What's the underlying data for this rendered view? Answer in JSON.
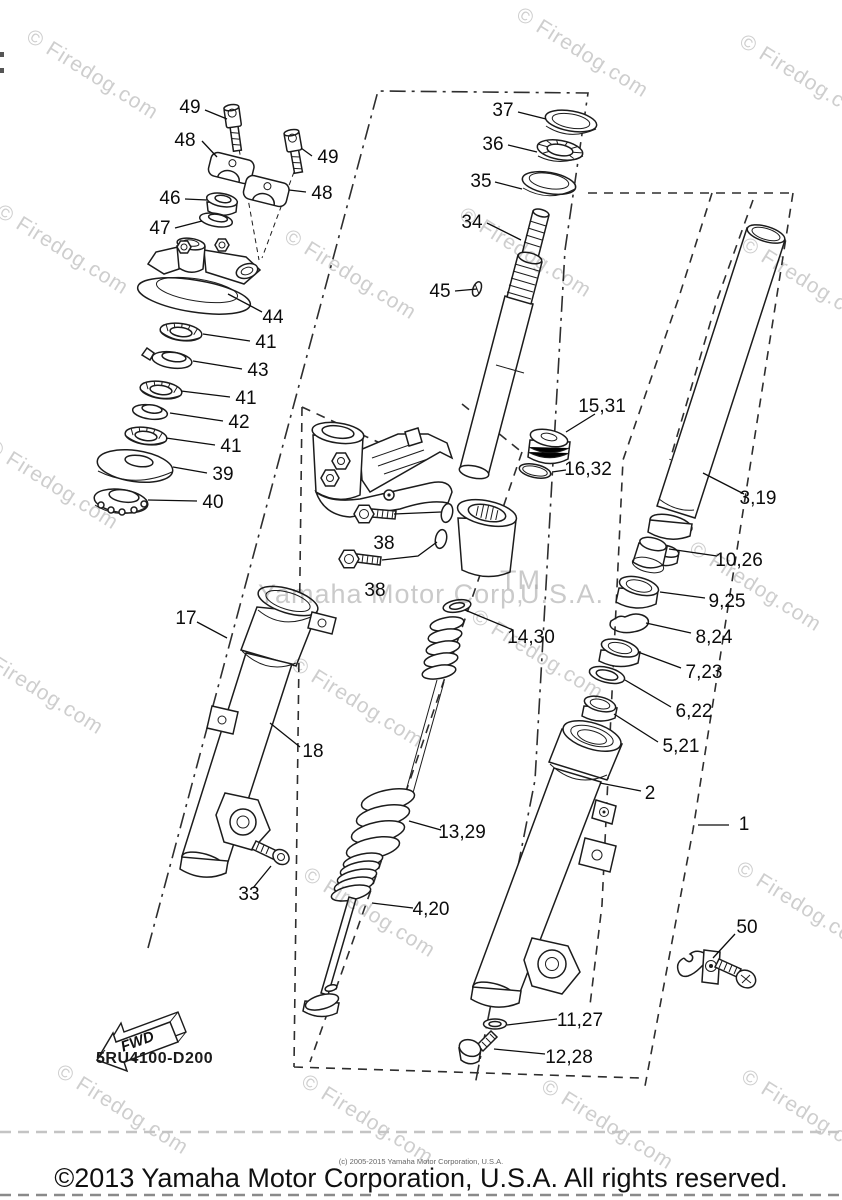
{
  "diagram": {
    "assembly_code": "5RU4100-D200",
    "fwd_label": "FWD",
    "watermark": "© Firedog.com",
    "watermark_center_1": "Yamaha Motor Corp,",
    "watermark_center_tm": "TM",
    "watermark_center_2": "U.S.A.",
    "copyright_small": "(c) 2005-2015 Yamaha Motor Corporation, U.S.A.",
    "copyright": "©2013 Yamaha Motor Corporation, U.S.A. All rights reserved.",
    "callouts": [
      {
        "id": "49a",
        "label": "49"
      },
      {
        "id": "48a",
        "label": "48"
      },
      {
        "id": "49b",
        "label": "49"
      },
      {
        "id": "48b",
        "label": "48"
      },
      {
        "id": "46",
        "label": "46"
      },
      {
        "id": "47",
        "label": "47"
      },
      {
        "id": "44",
        "label": "44"
      },
      {
        "id": "41a",
        "label": "41"
      },
      {
        "id": "43",
        "label": "43"
      },
      {
        "id": "41b",
        "label": "41"
      },
      {
        "id": "42",
        "label": "42"
      },
      {
        "id": "41c",
        "label": "41"
      },
      {
        "id": "39",
        "label": "39"
      },
      {
        "id": "40",
        "label": "40"
      },
      {
        "id": "37",
        "label": "37"
      },
      {
        "id": "36",
        "label": "36"
      },
      {
        "id": "35",
        "label": "35"
      },
      {
        "id": "34",
        "label": "34"
      },
      {
        "id": "45",
        "label": "45"
      },
      {
        "id": "15-31",
        "label": "15,31"
      },
      {
        "id": "16-32",
        "label": "16,32"
      },
      {
        "id": "3-19",
        "label": "3,19"
      },
      {
        "id": "38a",
        "label": "38"
      },
      {
        "id": "38b",
        "label": "38"
      },
      {
        "id": "14-30",
        "label": "14,30"
      },
      {
        "id": "17",
        "label": "17"
      },
      {
        "id": "18",
        "label": "18"
      },
      {
        "id": "33",
        "label": "33"
      },
      {
        "id": "10-26",
        "label": "10,26"
      },
      {
        "id": "9-25",
        "label": "9,25"
      },
      {
        "id": "8-24",
        "label": "8,24"
      },
      {
        "id": "7-23",
        "label": "7,23"
      },
      {
        "id": "6-22",
        "label": "6,22"
      },
      {
        "id": "5-21",
        "label": "5,21"
      },
      {
        "id": "2",
        "label": "2"
      },
      {
        "id": "1",
        "label": "1"
      },
      {
        "id": "50",
        "label": "50"
      },
      {
        "id": "11-27",
        "label": "11,27"
      },
      {
        "id": "12-28",
        "label": "12,28"
      },
      {
        "id": "13-29",
        "label": "13,29"
      },
      {
        "id": "4-20",
        "label": "4,20"
      }
    ]
  }
}
